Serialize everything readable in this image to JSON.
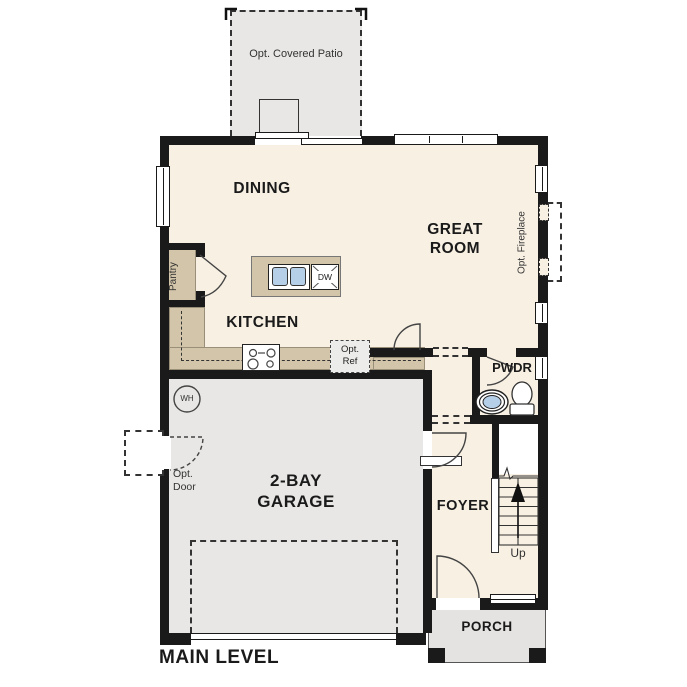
{
  "plan_title": "MAIN LEVEL",
  "rooms": {
    "patio": {
      "label": "Opt. Covered Patio"
    },
    "dining": {
      "label": "DINING"
    },
    "great_room": {
      "label": "GREAT\nROOM"
    },
    "kitchen": {
      "label": "KITCHEN"
    },
    "pantry": {
      "label": "Pantry"
    },
    "powder": {
      "label": "PWDR"
    },
    "garage": {
      "label": "2-BAY\nGARAGE"
    },
    "foyer": {
      "label": "FOYER"
    },
    "porch": {
      "label": "PORCH"
    }
  },
  "fixtures": {
    "dishwasher": {
      "label": "DW"
    },
    "opt_ref": {
      "label": "Opt.\nRef"
    },
    "opt_fireplace": {
      "label": "Opt. Fireplace"
    },
    "water_heater": {
      "label": "WH"
    },
    "opt_door": {
      "label": "Opt.\nDoor"
    },
    "stairs": {
      "label": "Up"
    }
  },
  "colors": {
    "interior_cream": "#f8f0e3",
    "counter_tan": "#d3c5a9",
    "concrete_gray": "#e8e7e5",
    "porch_gray": "#e4e3e1",
    "wall_black": "#1a1a1a",
    "sink_blue": "#b5cfe9"
  }
}
